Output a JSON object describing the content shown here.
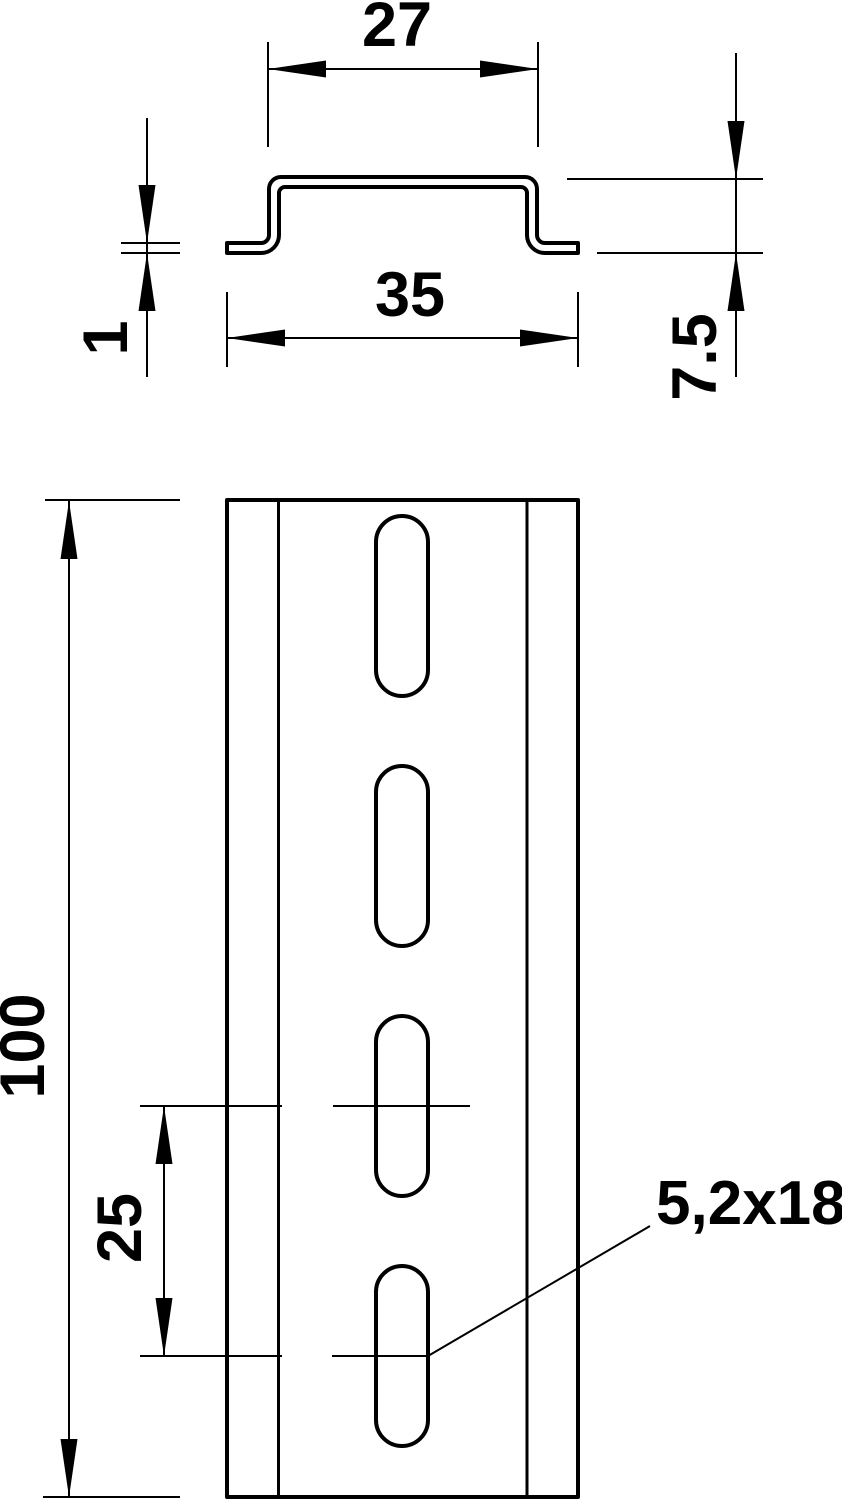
{
  "drawing": {
    "background_color": "#ffffff",
    "line_color": "#000000",
    "cross_section_view": {
      "top_width_label": "27",
      "overall_width_label": "35",
      "height_label": "7.5",
      "thickness_label": "1"
    },
    "front_view": {
      "length_label": "100",
      "slot_spacing_label": "25",
      "slot_size_label": "5,2x18",
      "slot_count": 4
    }
  }
}
